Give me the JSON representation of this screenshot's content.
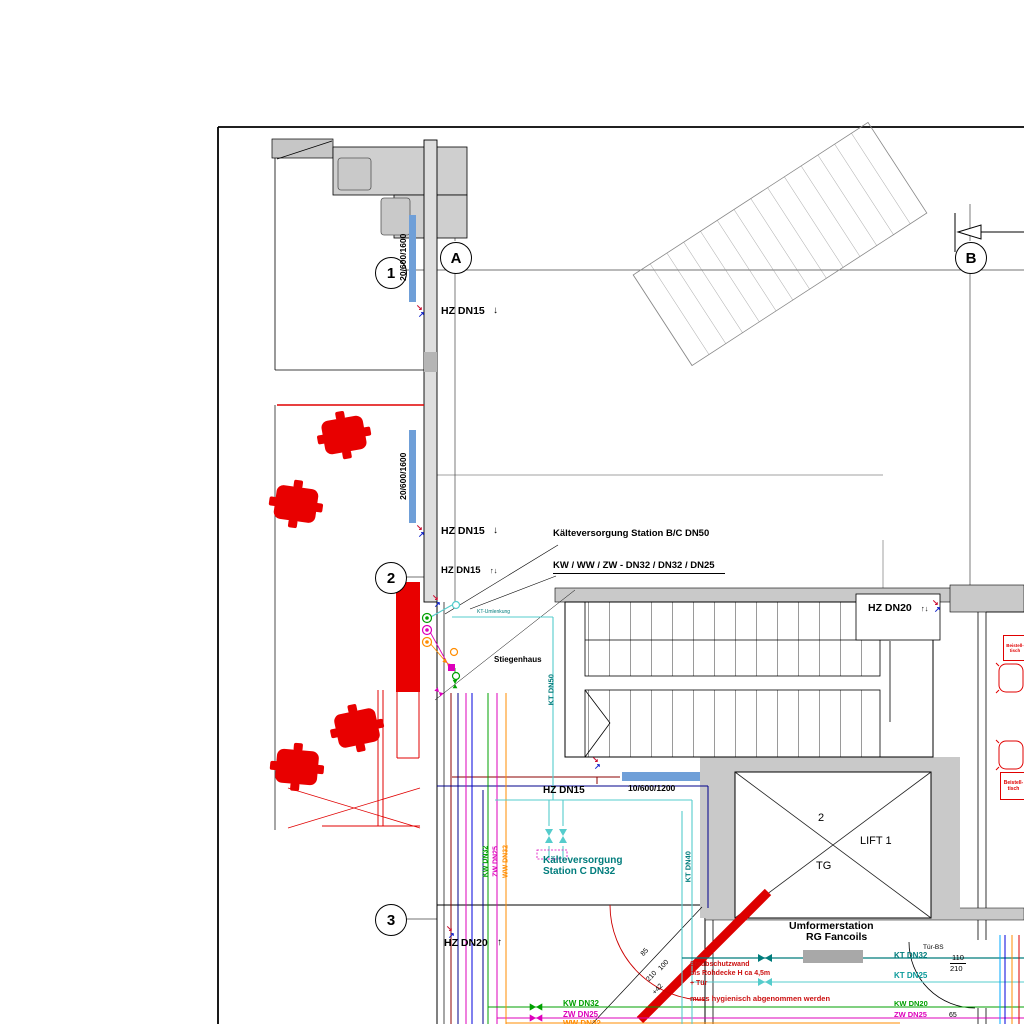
{
  "grid": {
    "r1": "1",
    "r2": "2",
    "r3": "3",
    "cA": "A",
    "cB": "B"
  },
  "labels": {
    "hz_dn15": "HZ DN15",
    "hz_dn20": "HZ DN20",
    "arrow_down": "↓",
    "arrow_up": "↑",
    "arrow_updown": "↑↓",
    "kaelte_bc": "Kälteversorgung Station B/C DN50",
    "kw_ww_zw": "KW / WW / ZW - DN32 / DN32 / DN25",
    "window_large": "20/600/1600",
    "window_small": "10/600/1200",
    "stiegenhaus": "Stiegenhaus",
    "kt_dn50": "KT DN50",
    "kt_dn40": "KT DN40",
    "kt_dn32": "KT DN32",
    "kt_dn25": "KT DN25",
    "kt_note": "KT-Umlenkung",
    "station_c_1": "Kälteversorgung",
    "station_c_2": "Station C DN32",
    "kw_dn32": "KW DN32",
    "zw_dn25": "ZW DN25",
    "ww_dn32": "WW DN32",
    "kw_dn20": "KW DN20",
    "lift_number": "2",
    "lift_name": "LIFT 1",
    "lift_tg": "TG",
    "umformer_1": "Umformerstation",
    "umformer_2": "RG Fancoils",
    "note_staub_1": "Staubschutzwand",
    "note_staub_2": "bis Rohdecke H ca 4,5m",
    "note_staub_3": "+ Tür",
    "note_hygiene": "muss hygienisch abgenommen werden",
    "tuer_bs": "Tür-BS",
    "door_w": "110",
    "door_h": "210",
    "dim_65": "65",
    "dim_85": "85",
    "dim_100": "100",
    "dim_210": "210",
    "dim_42": "+42",
    "beistell_1": "Beistell-",
    "beistell_2": "tisch"
  },
  "colors": {
    "wall_gray": "#c9c9c9",
    "red": "#e00000",
    "window_blue": "#6f9fd8",
    "kt_dark": "#007c7c",
    "kt_light": "#55cccc",
    "kw_green": "#00a000",
    "zw_magenta": "#dd00bb",
    "ww_orange": "#ff8c00",
    "hz_blue": "#00008b",
    "hz_red": "#8b0000"
  }
}
